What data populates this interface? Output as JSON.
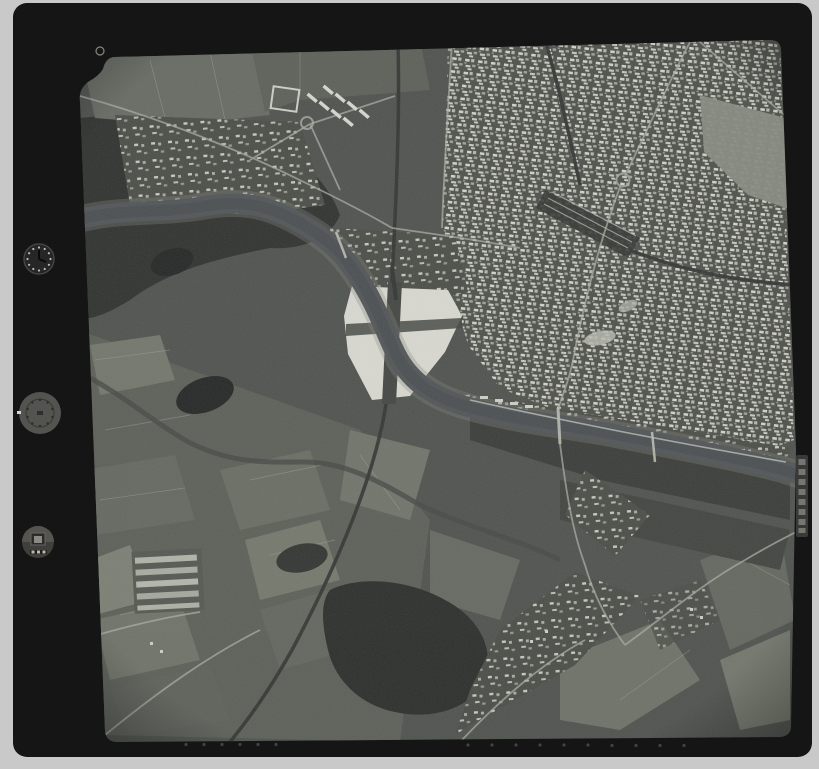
{
  "scene": {
    "summary": "Black-and-white vertical aerial photograph (scanned film frame) of a riverside city with dense urban fabric upper right, a large bright parade ground at center crossed by a dark railway, a meandering river, farmland patchwork lower left and dark woodland",
    "film_frame": {
      "fiducial": "small ring mark in notched top-left photo corner",
      "edge_label_text": "(illegible vertical marking)",
      "bottom_edge_dot_count": 16,
      "instruments": [
        {
          "name": "clock-dial",
          "reading": "(illegible)"
        },
        {
          "name": "altimeter-dial",
          "reading": "(illegible)"
        },
        {
          "name": "frame-counter",
          "reading": "(illegible)"
        }
      ]
    }
  },
  "palette": {
    "background": "#c9c9c9",
    "film": "#151515",
    "photo_base": "#484c47",
    "woods": "#272a27",
    "forest": "#232623",
    "pond": "#1c1e1d",
    "water": "#4b4f52",
    "water_core": "#42464a",
    "bank": "#7e827a",
    "plaza": "#dadad2",
    "plaza_cross": "#3c3f3b",
    "field_light": "#83877c",
    "field_mid": "#62665e",
    "road": "#a6aa9e",
    "road_bright": "#b9bdb1",
    "rail": "#2b2e2b",
    "tank": "#ecece6",
    "clock_face": "#262626",
    "altimeter_face": "#53534f",
    "counter_face": "#403f3c",
    "label_strip": "#3f3f3f",
    "label_char": "#a8a8a0",
    "edge_dot": "#555555",
    "fiducial_ring": "#9a9a93"
  }
}
